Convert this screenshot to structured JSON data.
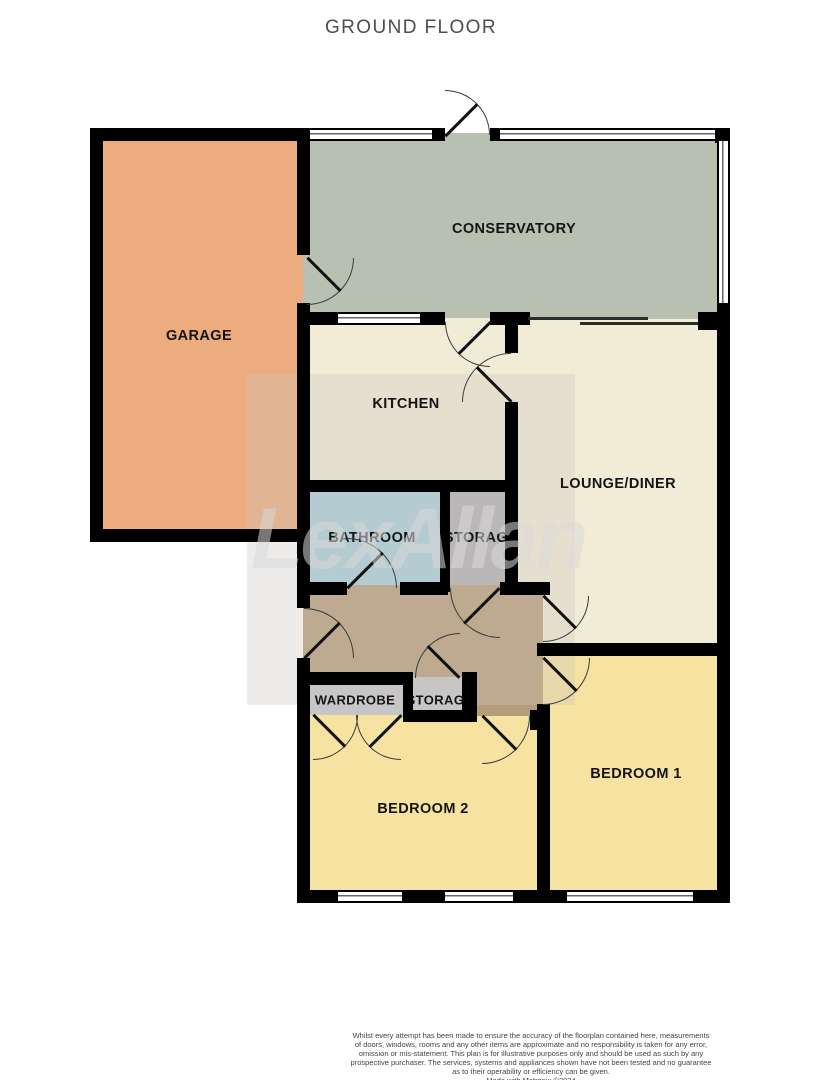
{
  "title": "GROUND FLOOR",
  "watermark": "LexAllan",
  "rooms": [
    {
      "id": "garage",
      "label": "GARAGE"
    },
    {
      "id": "conservatory",
      "label": "CONSERVATORY"
    },
    {
      "id": "kitchen",
      "label": "KITCHEN"
    },
    {
      "id": "lounge-diner",
      "label": "LOUNGE/DINER"
    },
    {
      "id": "bathroom",
      "label": "BATHROOM"
    },
    {
      "id": "storage-upper",
      "label": "STORAGE"
    },
    {
      "id": "wardrobe",
      "label": "WARDROBE"
    },
    {
      "id": "storage-lower",
      "label": "STORAGE"
    },
    {
      "id": "bedroom-2",
      "label": "BEDROOM 2"
    },
    {
      "id": "bedroom-1",
      "label": "BEDROOM 1"
    }
  ],
  "colors": {
    "garage": "#ecac7e",
    "conservatory": "#b8c0b2",
    "kitchen_lounge": "#f1ecd6",
    "bathroom": "#a7ceda",
    "storage": "#b2b0b4",
    "hallway": "#b69d7a",
    "wardrobe_storage": "#c6c5ca",
    "bedrooms": "#f6e3a1",
    "walls": "#000000"
  },
  "disclaimer": {
    "lines": [
      "Whilst every attempt has been made to ensure the accuracy of the floorplan contained here, measurements",
      "of doors, windows, rooms and any other items are approximate and no responsibility is taken for any error,",
      "omission or mis-statement. This plan is for illustrative purposes only and should be used as such by any",
      "prospective purchaser. The services, systems and appliances shown have not been tested and no guarantee",
      "as to their operability or efficiency can be given.",
      "Made with Metropix ©2024"
    ]
  }
}
